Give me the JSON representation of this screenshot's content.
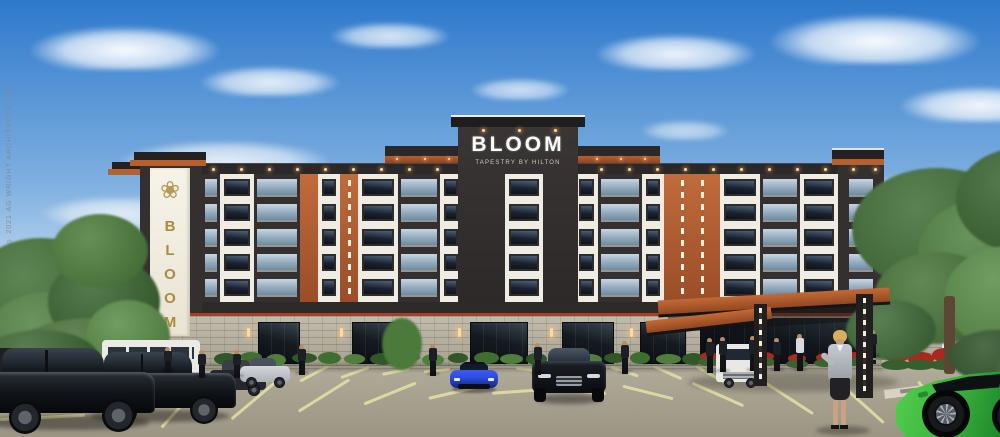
{
  "signs": {
    "main_sign": {
      "title": "BLOOM",
      "subtitle": "TAPESTRY BY HILTON"
    },
    "tower_sign": {
      "text": "BLOOM",
      "flower_glyph": "❀"
    }
  },
  "copyright": {
    "text": "© 2021 AG WRIGHT ARCHITECTS INC."
  },
  "colors": {
    "sky_top": "#2e79cc",
    "sky_mid": "#7fb0e0",
    "sky_horizon": "#e9f1f7",
    "facade_charcoal": "#34302f",
    "facade_cream": "#efece3",
    "accent_rust": "#b4602f",
    "accent_rust_dark": "#8f4423",
    "sign_gold": "#ab8c3f",
    "stone_gray": "#b6afa0",
    "asphalt": "#aba593",
    "stall_line_yellow": "#e6e2a6",
    "foliage_green": "#4a7a39",
    "flower_red": "#a8291f",
    "car_blue": "#2d4fe0",
    "car_green": "#3db53e"
  }
}
